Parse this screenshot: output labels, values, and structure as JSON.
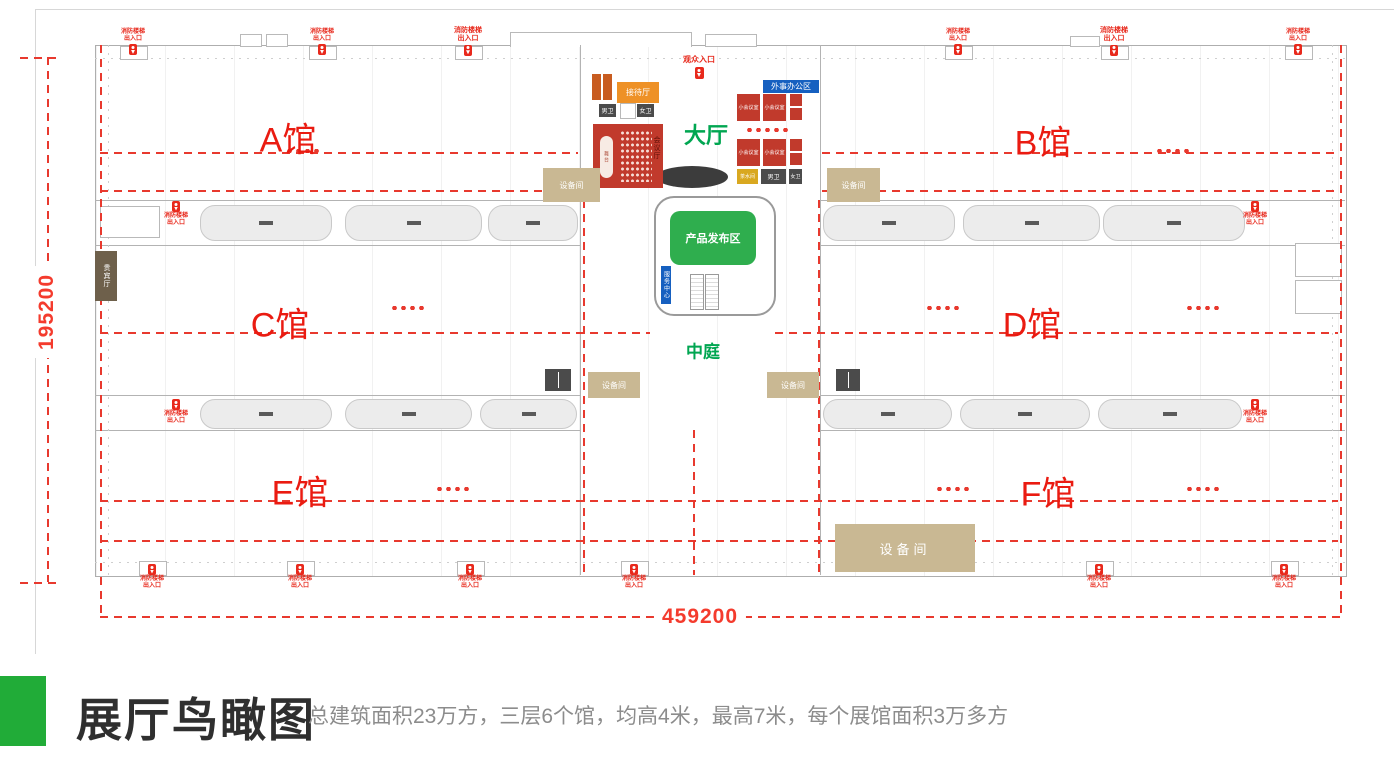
{
  "plan": {
    "dimension_width": "459200",
    "dimension_height": "195200",
    "halls": [
      {
        "id": "A",
        "label": "A馆"
      },
      {
        "id": "B",
        "label": "B馆"
      },
      {
        "id": "C",
        "label": "C馆"
      },
      {
        "id": "D",
        "label": "D馆"
      },
      {
        "id": "E",
        "label": "E馆"
      },
      {
        "id": "F",
        "label": "F馆"
      }
    ],
    "zones": {
      "main_hall": "大厅",
      "atrium": "中庭",
      "product_launch": "产品发布区",
      "service_desk": "服务中心"
    },
    "rooms": {
      "reception": "接待厅",
      "conference": "会议厅",
      "stage": "舞台",
      "meeting_small": "小会议室",
      "office_zone": "外事办公区",
      "tea_room": "茶水间",
      "toilet_male": "男卫",
      "toilet_female": "女卫",
      "equipment": "设备间",
      "vip_lounge": "贵宾厅"
    },
    "entrances": {
      "visitor": "观众入口",
      "fire_line1": "消防楼梯",
      "fire_line2": "出入口"
    }
  },
  "footer": {
    "title": "展厅鸟瞰图",
    "subtitle": "总建筑面积23万方，三层6个馆，均高4米，最高7米，每个展馆面积3万多方"
  },
  "colors": {
    "accent_green": "#21ac38",
    "annotation_red": "#e8392e",
    "hall_label_red": "#ea1b11",
    "zone_green": "#00a651",
    "product_zone_green": "#2fae4e",
    "office_blue": "#1660c0",
    "room_red": "#c13a2c",
    "reception_orange": "#ee9126",
    "equipment_beige": "#c9b893",
    "tea_yellow": "#d9a820",
    "toilet_gray": "#4b4b4b"
  }
}
